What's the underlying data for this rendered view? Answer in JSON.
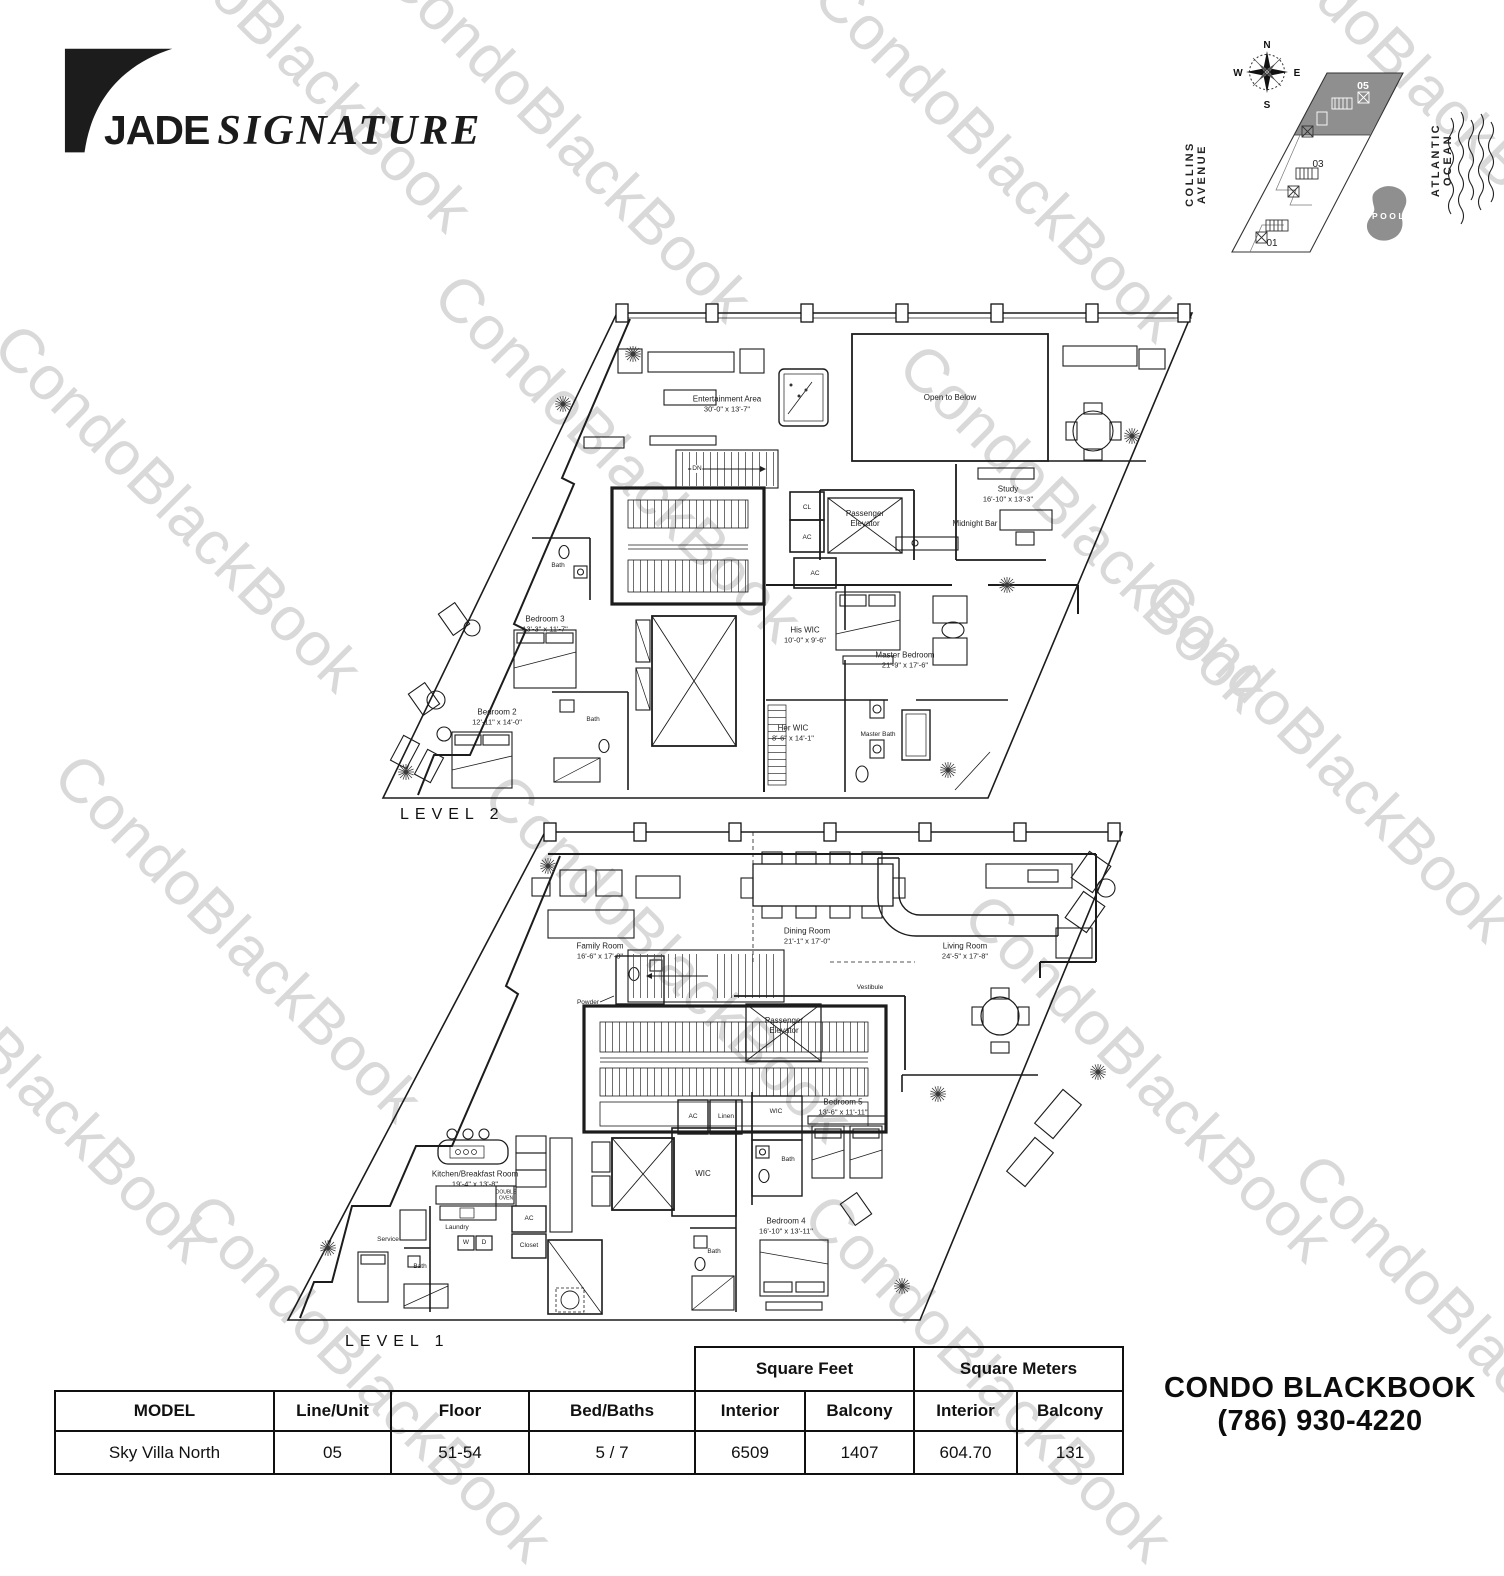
{
  "watermark": {
    "text": "CondoBlackBook",
    "color": "#d9d9d9"
  },
  "brand": {
    "word1": "JADE",
    "word2": "SIGNATURE"
  },
  "site_map": {
    "compass": {
      "n": "N",
      "e": "E",
      "s": "S",
      "w": "W"
    },
    "street": "COLLINS AVENUE",
    "ocean": "ATLANTIC OCEAN",
    "pool": "POOL",
    "unit_05": "05",
    "unit_03": "03",
    "unit_01": "01",
    "highlight_color": "#8f8f8f"
  },
  "level2": {
    "label": "LEVEL 2",
    "rooms": {
      "entertainment": {
        "name": "Entertainment Area",
        "dims": "30'-0\" x 13'-7\""
      },
      "open_below": {
        "name": "Open to Below"
      },
      "dn": {
        "name": "DN"
      },
      "cl": {
        "name": "CL"
      },
      "ac1": {
        "name": "AC"
      },
      "ac2": {
        "name": "AC"
      },
      "elevator": {
        "name": "Passenger Elevator"
      },
      "midnight_bar": {
        "name": "Midnight Bar"
      },
      "study": {
        "name": "Study",
        "dims": "16'-10\" x 13'-3\""
      },
      "bath1": {
        "name": "Bath"
      },
      "bedroom3": {
        "name": "Bedroom 3",
        "dims": "13'-3\" x 11'-7\""
      },
      "bedroom2": {
        "name": "Bedroom 2",
        "dims": "12'-11\" x 14'-0\""
      },
      "bath2": {
        "name": "Bath"
      },
      "his_wic": {
        "name": "His WIC",
        "dims": "10'-0\" x 9'-6\""
      },
      "master_bedroom": {
        "name": "Master Bedroom",
        "dims": "21'-9\" x 17'-6\""
      },
      "her_wic": {
        "name": "Her WIC",
        "dims": "8'-6\" x 14'-1\""
      },
      "master_bath": {
        "name": "Master Bath"
      }
    }
  },
  "level1": {
    "label": "LEVEL 1",
    "rooms": {
      "family": {
        "name": "Family Room",
        "dims": "16'-6\" x 17'-8\""
      },
      "dining": {
        "name": "Dining Room",
        "dims": "21'-1\" x 17'-0\""
      },
      "living": {
        "name": "Living Room",
        "dims": "24'-5\" x 17'-8\""
      },
      "powder": {
        "name": "Powder"
      },
      "vestibule": {
        "name": "Vestibule"
      },
      "elevator": {
        "name": "Passenger Elevator"
      },
      "kitchen": {
        "name": "Kitchen/Breakfast Room",
        "dims": "19'-4\" x 13'-8\""
      },
      "double_oven": {
        "name": "DOUBLE OVEN"
      },
      "laundry": {
        "name": "Laundry"
      },
      "service": {
        "name": "Service"
      },
      "bath_service": {
        "name": "Bath"
      },
      "w": {
        "name": "W"
      },
      "d": {
        "name": "D"
      },
      "ac1": {
        "name": "AC"
      },
      "closet": {
        "name": "Closet"
      },
      "ac2": {
        "name": "AC"
      },
      "linen": {
        "name": "Linen"
      },
      "wic1": {
        "name": "WIC"
      },
      "wic2": {
        "name": "WIC"
      },
      "bath5": {
        "name": "Bath"
      },
      "bedroom5": {
        "name": "Bedroom 5",
        "dims": "13'-6\" x 11'-11\""
      },
      "bedroom4": {
        "name": "Bedroom 4",
        "dims": "16'-10\" x 13'-11\""
      },
      "bath4": {
        "name": "Bath"
      }
    }
  },
  "table": {
    "group_headers": {
      "sqft": "Square Feet",
      "sqm": "Square Meters"
    },
    "columns": [
      "MODEL",
      "Line/Unit",
      "Floor",
      "Bed/Baths",
      "Interior",
      "Balcony",
      "Interior",
      "Balcony"
    ],
    "row": [
      "Sky Villa North",
      "05",
      "51-54",
      "5 / 7",
      "6509",
      "1407",
      "604.70",
      "131"
    ]
  },
  "contact": {
    "line1": "CONDO BLACKBOOK",
    "line2": "(786) 930-4220"
  }
}
